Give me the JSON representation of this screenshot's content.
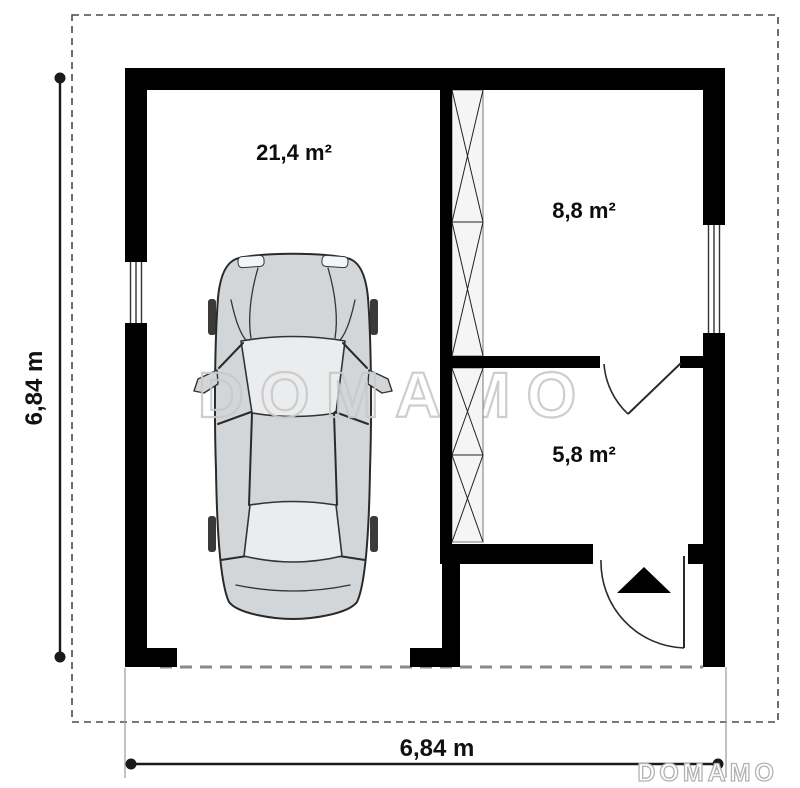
{
  "plan": {
    "rooms": {
      "garage": {
        "area": "21,4 m²"
      },
      "top_right": {
        "area": "8,8 m²"
      },
      "bottom_right": {
        "area": "5,8 m²"
      }
    },
    "dimensions": {
      "left": "6,84 m",
      "bottom": "6,84 m"
    }
  },
  "watermark": {
    "center": "DOMAMO",
    "footer": "DOMAMO"
  },
  "colors": {
    "wall": "#000000",
    "shaft_fill": "#f5f5f5",
    "car_body": "#d3d6d8",
    "car_glass": "#eaeced",
    "plot_dash": "#4a4a4a",
    "roof_dash": "#8a8a8a",
    "watermark": "#c9c9c9"
  }
}
